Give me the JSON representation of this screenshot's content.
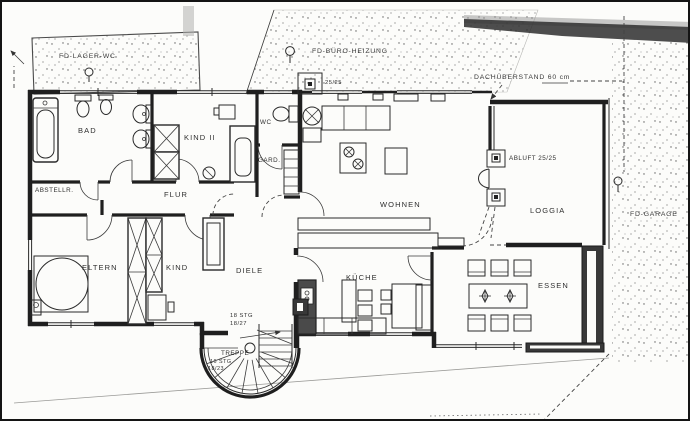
{
  "document": {
    "type": "scanned floor plan",
    "paper_color": "#fcfcfa",
    "ink_color": "#2a2a2a"
  },
  "roof_annotations": {
    "fd_lager_wc": "FD-LAGER-WC",
    "fd_buero_heizung": "FD-BÜRO-HEIZUNG",
    "dachueberstand": "DACHÜBERSTAND  60 cm",
    "fd_garage": "FD-GARAGE"
  },
  "rooms": {
    "bad": "BAD",
    "kind2": "KIND II",
    "wc": "WC",
    "gard": "GARD.",
    "abstellr": "ABSTELLR.",
    "flur": "FLUR",
    "eltern": "ELTERN",
    "kind": "KIND",
    "diele": "DIELE",
    "wohnen": "WOHNEN",
    "kueche": "KÜCHE",
    "essen": "ESSEN",
    "loggia": "LOGGIA",
    "treppe": "TREPPE"
  },
  "technical": {
    "chimney_size": "25/25",
    "abluft_shaft": "ABLUFT 25/25",
    "stairs_up_line1": "18 STG",
    "stairs_up_line2": "18/27",
    "stairs_down_line1": "16 STG",
    "stairs_down_line2": "18/23"
  }
}
